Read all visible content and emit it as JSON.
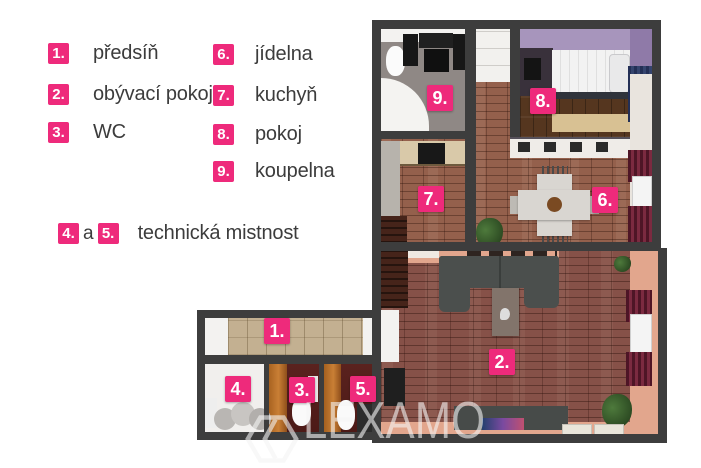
{
  "legend": {
    "col1": [
      {
        "num": "1.",
        "label": "předsíň"
      },
      {
        "num": "2.",
        "label": "obývací pokoj"
      },
      {
        "num": "3.",
        "label": "WC"
      }
    ],
    "col2": [
      {
        "num": "6.",
        "label": "jídelna"
      },
      {
        "num": "7.",
        "label": "kuchyň"
      },
      {
        "num": "8.",
        "label": "pokoj"
      },
      {
        "num": "9.",
        "label": "koupelna"
      }
    ],
    "combo": {
      "num_a": "4.",
      "conj": "a",
      "num_b": "5.",
      "label": "technická mistnost"
    }
  },
  "plan": {
    "markers": {
      "m1": "1.",
      "m2": "2.",
      "m3": "3.",
      "m4": "4.",
      "m5": "5.",
      "m6": "6.",
      "m7": "7.",
      "m8": "8.",
      "m9": "9."
    }
  },
  "watermark": {
    "text": "LEXAMO"
  },
  "colors": {
    "accent_pink": "#ee2a7b",
    "wall": "#3d3d3d",
    "brick_floor": "#94604c",
    "living_walls_salmon": "#e2a68d",
    "bedroom_purple": "#a795bc",
    "curtain_maroon": "#6b2034",
    "legend_text": "#3c3c3c"
  }
}
